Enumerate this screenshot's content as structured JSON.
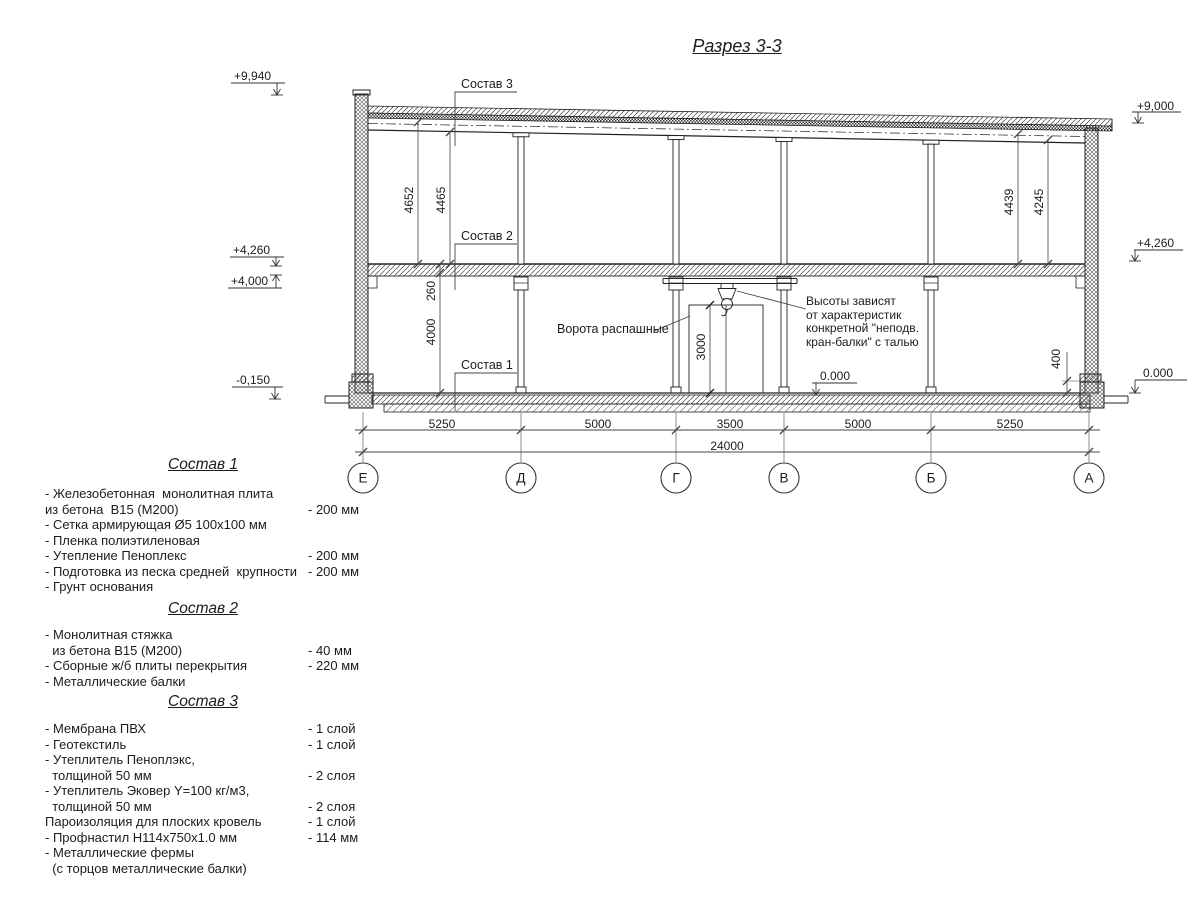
{
  "title": "Разрез 3-3",
  "elevations": {
    "roof_left": "+9,940",
    "roof_right": "+9,000",
    "slab_top_left": "+4,260",
    "slab_bottom_left": "+4,000",
    "ground_outside_left": "-0,150",
    "floor_mid": "0.000",
    "floor_right": "0.000",
    "slab_top_right": "+4,260"
  },
  "dims": {
    "left_outer": "4652",
    "left_inner": "4465",
    "right_outer": "4439",
    "right_inner": "4245",
    "slab_thickness": "260",
    "first_floor_height": "4000",
    "gate_height": "3000",
    "plinth_height": "400",
    "spans": [
      "5250",
      "5000",
      "3500",
      "5000",
      "5250"
    ],
    "total": "24000"
  },
  "axes": [
    "Е",
    "Д",
    "Г",
    "В",
    "Б",
    "А"
  ],
  "callouts": {
    "sostav3": "Состав 3",
    "sostav2": "Состав 2",
    "sostav1": "Состав 1",
    "gates": "Ворота распашные",
    "crane_note": [
      "Высоты зависят",
      "от характеристик",
      "конкретной \"неподв.",
      "кран-балки\" с талью"
    ]
  },
  "specs": [
    {
      "heading": "Состав 1",
      "lines": [
        {
          "text": "- Железобетонная  монолитная плита",
          "value": ""
        },
        {
          "text": "из бетона  В15 (М200)",
          "value": "- 200 мм"
        },
        {
          "text": "- Сетка армирующая Ø5 100х100 мм",
          "value": ""
        },
        {
          "text": "- Пленка полиэтиленовая",
          "value": ""
        },
        {
          "text": "- Утепление Пеноплекс",
          "value": "- 200 мм"
        },
        {
          "text": "- Подготовка из песка средней  крупности",
          "value": "- 200 мм"
        },
        {
          "text": "- Грунт основания",
          "value": ""
        }
      ]
    },
    {
      "heading": "Состав 2",
      "lines": [
        {
          "text": "- Монолитная стяжка",
          "value": ""
        },
        {
          "text": "  из бетона В15 (М200)",
          "value": "- 40 мм"
        },
        {
          "text": "- Сборные ж/б плиты перекрытия",
          "value": "- 220 мм"
        },
        {
          "text": "- Металлические балки",
          "value": ""
        }
      ]
    },
    {
      "heading": "Состав 3",
      "lines": [
        {
          "text": "- Мембрана ПВХ",
          "value": "- 1 слой"
        },
        {
          "text": "- Геотекстиль",
          "value": "- 1 слой"
        },
        {
          "text": "- Утеплитель Пеноплэкс,",
          "value": ""
        },
        {
          "text": "  толщиной 50 мм",
          "value": "- 2 слоя"
        },
        {
          "text": "- Утеплитель Эковер Y=100 кг/м3,",
          "value": ""
        },
        {
          "text": "  толщиной 50 мм",
          "value": "- 2 слоя"
        },
        {
          "text": "Пароизоляция для плоских кровель",
          "value": "- 1 слой"
        },
        {
          "text": "- Профнастил Н114х750х1.0 мм",
          "value": "- 114 мм"
        },
        {
          "text": "- Металлические фермы",
          "value": ""
        },
        {
          "text": "  (с торцов металлические балки)",
          "value": ""
        }
      ]
    }
  ]
}
